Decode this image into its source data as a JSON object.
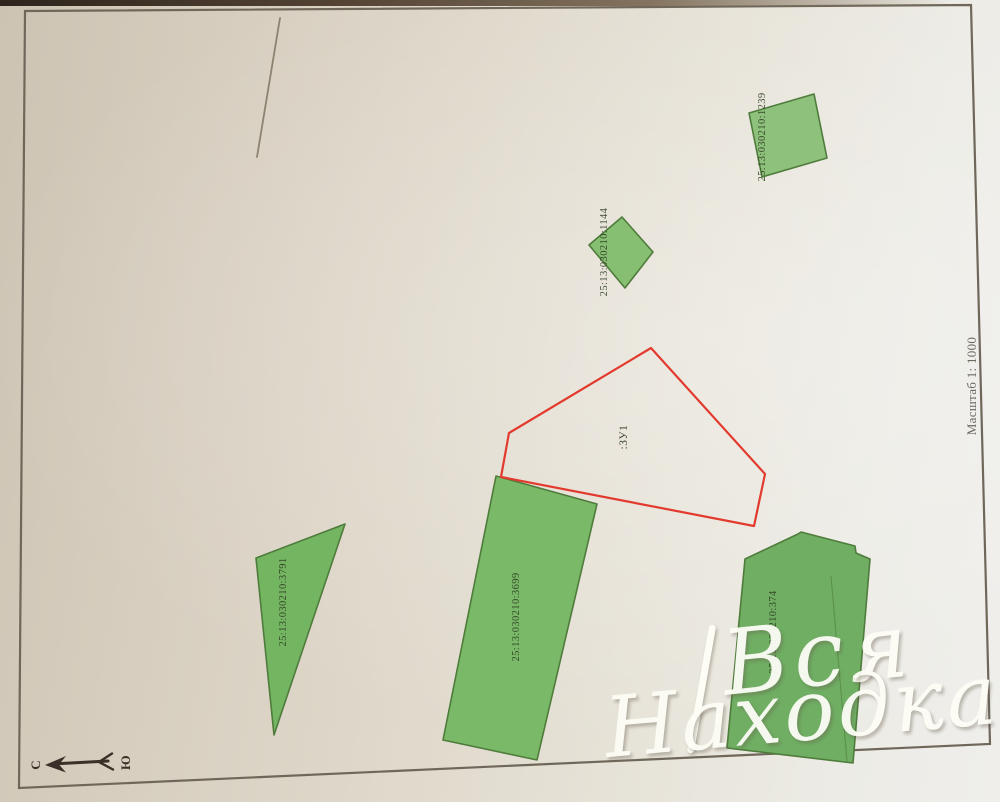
{
  "map": {
    "scale_label": "Масштаб 1: 1000",
    "compass": {
      "north_label": "С",
      "south_label": "Ю"
    },
    "frame": {
      "points": "25,11 971,5 990,744 19,788",
      "color": "#6f675a"
    },
    "stray_mark": {
      "x1": 280,
      "y1": 18,
      "x2": 257,
      "y2": 157,
      "color": "#8d8271"
    },
    "colors": {
      "paper": "#e3ddd2",
      "parcel_border": "#4f7c3c",
      "parcel_label_text": "#2c3a21",
      "subject_outline": "#e23b2e",
      "scale_text": "#57524a",
      "compass_ink": "#3a3027"
    },
    "subject_parcel": {
      "label": ":ЗУ1",
      "points": "651,348 765,474 754,526 501,477 509,433",
      "label_x": 627,
      "label_y": 437
    },
    "parcels": [
      {
        "label": "25:13:030210:1239",
        "points": "749,113 814,94 827,158 762,177",
        "fill": "#8ec17b",
        "label_x": 765,
        "label_y": 137
      },
      {
        "label": "25:13:030210:1144",
        "points": "622,217 653,252 625,288 589,245",
        "fill": "#86be72",
        "label_x": 607,
        "label_y": 252
      },
      {
        "label": "25:13:030210:3791",
        "points": "345,524 256,558 274,735",
        "fill": "#74b562",
        "label_x": 286,
        "label_y": 602
      },
      {
        "label": "25:13:030210:3699",
        "points": "496,476 597,504 537,760 443,740",
        "fill": "#79b967",
        "label_x": 519,
        "label_y": 617
      },
      {
        "label": "25:13:030210:374",
        "points": "745,559 798,534 801,532 855,546 856,553 870,559 853,763 727,748",
        "fill": "#6fae63",
        "label_x": 776,
        "label_y": 632,
        "seam": "831,576 847,761"
      }
    ]
  },
  "watermark": {
    "line1": "Вся",
    "line2": "Находка",
    "color": "#fdfdf6"
  }
}
